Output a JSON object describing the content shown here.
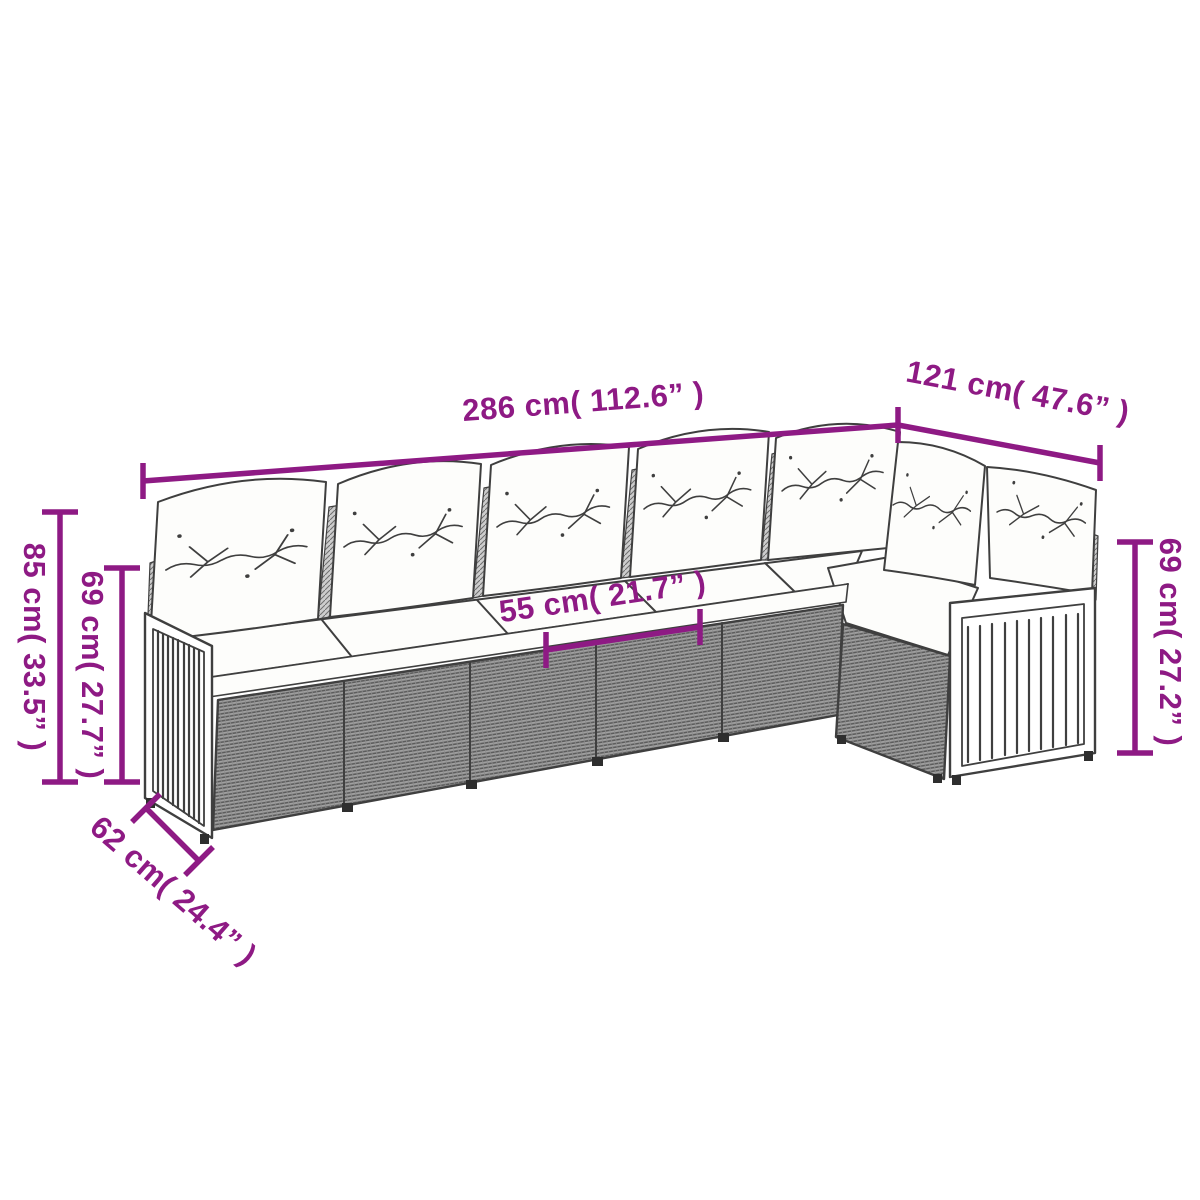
{
  "colors": {
    "background": "#ffffff",
    "accent": "#8e1a84",
    "line": "#3f3f3f",
    "rattan_fill": "#a0a0a0",
    "cushion_fill": "#fdfdfb"
  },
  "dimensions": {
    "top_length": {
      "label": "286 cm( 112.6” )"
    },
    "right_depth": {
      "label": "121 cm( 47.6” )"
    },
    "left_height_outer": {
      "label": "85 cm( 33.5” )"
    },
    "left_height_inner": {
      "label": "69 cm( 27.7” )"
    },
    "right_height": {
      "label": "69 cm( 27.2” )"
    },
    "seat_width": {
      "label": "55 cm( 21.7” )"
    },
    "front_depth": {
      "label": "62 cm( 24.4” )"
    }
  }
}
